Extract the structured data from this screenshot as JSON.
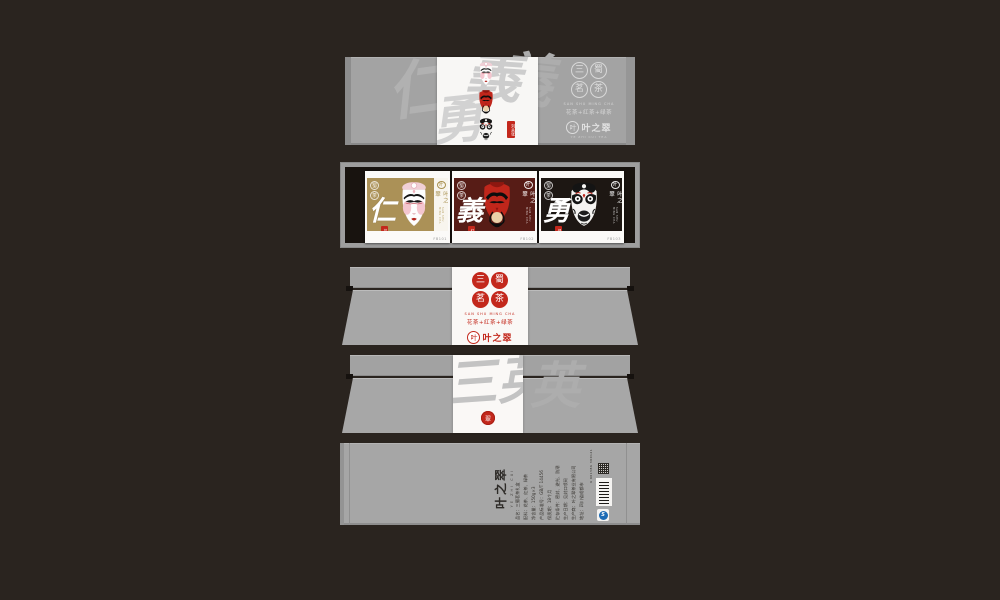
{
  "canvas": {
    "background": "#2a241f",
    "panel_gray": "#a4a4a4",
    "accent_red": "#c3281c"
  },
  "brand": {
    "seals": [
      {
        "char": "三"
      },
      {
        "char": "蜀"
      },
      {
        "char": "茗"
      },
      {
        "char": "茶"
      }
    ],
    "pinyin": "SAN SHU MING CHA",
    "tea_line": "花茶+红茶+绿茶",
    "corner_seals": [
      {
        "char": "蜀"
      },
      {
        "char": "茶"
      }
    ],
    "logo": {
      "seal_char": "叶",
      "name": "叶之翠",
      "sub": "YE ZHI CUI TEA"
    }
  },
  "lid": {
    "watermark": {
      "wm1": "仁",
      "wm2": "義",
      "wm3": "義",
      "wm4": "勇"
    },
    "side_tag": "刘关张"
  },
  "box_panel": {
    "boxes": [
      {
        "virtue": "仁",
        "tea_seal": "花茶",
        "code": "FB101",
        "color": "#ab9157",
        "mask": "liubei"
      },
      {
        "virtue": "義",
        "tea_seal": "红茶",
        "code": "FB102",
        "color": "#571c16",
        "mask": "guanyu"
      },
      {
        "virtue": "勇",
        "tea_seal": "绿茶",
        "code": "FB103",
        "color": "#1d1713",
        "mask": "zhangfei"
      }
    ]
  },
  "wrap_panel": {
    "watermark": "三英",
    "side_watermark": "英",
    "seal_char": "翠"
  },
  "info_panel": {
    "logo_name": "叶之翠",
    "logo_sub": "YE ZHI CUI",
    "info_lines": [
      "品名：三蜀茗茶礼盒",
      "配料：花茶、红茶、绿茶",
      "净含量：150g×3",
      "产品标准号：GB/T 14456",
      "保质期：18个月",
      "贮存条件：密封、避光、防潮",
      "生产日期：见封口喷码",
      "生产商：叶之翠茶业有限公司",
      "地址：四川省成都市"
    ],
    "barcode_number": "6 901586 300121",
    "qs_label": "S"
  }
}
